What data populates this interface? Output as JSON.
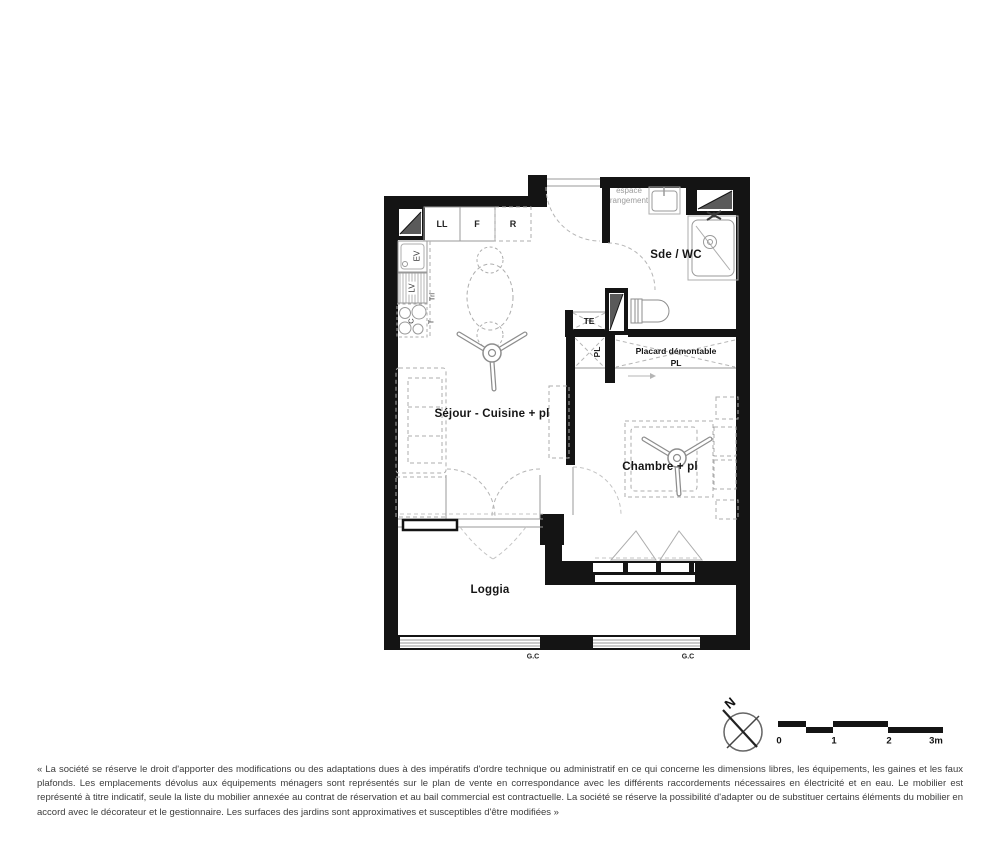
{
  "floorplan": {
    "rooms": {
      "sejour": "Séjour - Cuisine + pl",
      "chambre": "Chambre + pl",
      "sde_wc": "Sde / WC",
      "loggia": "Loggia",
      "espace_rangement": "espace rangement",
      "placard_line1": "Placard démontable",
      "placard_line2": "PL"
    },
    "equipment": {
      "ll": "LL",
      "f": "F",
      "r": "R",
      "ev": "EV",
      "lv": "LV",
      "c": "C",
      "tri": "Tri",
      "t": "T",
      "te": "TE",
      "pl": "PL",
      "gc": "G.C"
    },
    "colors": {
      "wall": "#141414",
      "furniture_stroke": "#9a9a9a",
      "shaft_fill": "#5a5a5a"
    }
  },
  "compass": {
    "north": "N"
  },
  "scale_bar": {
    "tick0": "0",
    "tick1": "1",
    "tick2": "2",
    "tick3": "3m"
  },
  "disclaimer": "« La société se réserve le droit d'apporter des modifications ou des adaptations dues à des impératifs d'ordre technique ou administratif en ce qui concerne les dimensions libres, les équipements, les gaines et les faux plafonds. Les emplacements dévolus aux équipements ménagers sont représentés sur le plan de vente en correspondance avec les différents raccordements nécessaires en électricité et en eau. Le mobilier est représenté à titre indicatif, seule la liste du mobilier annexée au contrat de réservation et au bail commercial est contractuelle. La société se réserve la possibilité d'adapter ou de substituer certains éléments du mobilier en accord avec le décorateur et le gestionnaire. Les surfaces des jardins sont approximatives et susceptibles d'être modifiées »"
}
